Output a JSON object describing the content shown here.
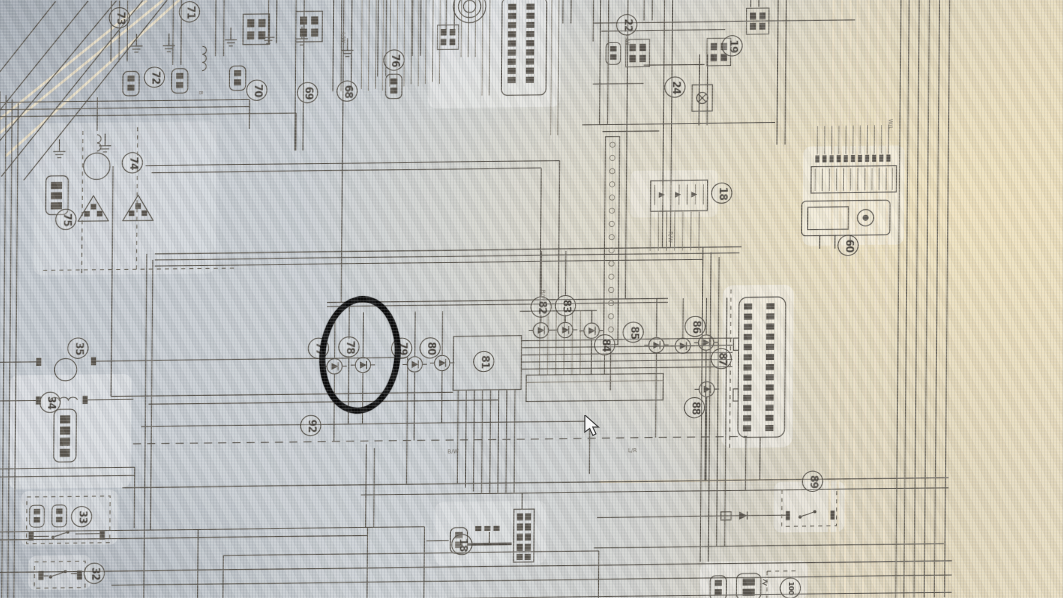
{
  "meta": {
    "description": "Photograph of a computer screen displaying a black-and-white automotive wiring diagram. Numbered circled connector references are scattered across the schematic. Component reference 78 is circled with a thick hand-drawn black marker oval. A mouse cursor arrow is visible right of center.",
    "content_type": "wiring-diagram-photo"
  },
  "colors": {
    "screen_cool": "#c6cbd1",
    "screen_warm": "#e3d8bc",
    "diagram_ink": "#5b564d",
    "diagram_ink_light": "#837d70",
    "highlight_wire": "#ecdfc3",
    "annotation_marker": "#0c0c0c",
    "cursor_fill": "#f8f8f8"
  },
  "diagram": {
    "refs": [
      {
        "label": "73",
        "x": 123,
        "y": 17
      },
      {
        "label": "71",
        "x": 192,
        "y": 12
      },
      {
        "label": "72",
        "x": 158,
        "y": 76
      },
      {
        "label": "70",
        "x": 259,
        "y": 90
      },
      {
        "label": "69",
        "x": 309,
        "y": 93
      },
      {
        "label": "68",
        "x": 348,
        "y": 92
      },
      {
        "label": "76",
        "x": 394,
        "y": 62
      },
      {
        "label": "22",
        "x": 623,
        "y": 30
      },
      {
        "label": "19",
        "x": 727,
        "y": 52
      },
      {
        "label": "24",
        "x": 671,
        "y": 92
      },
      {
        "label": "18",
        "x": 718,
        "y": 197
      },
      {
        "label": "60",
        "x": 843,
        "y": 250
      },
      {
        "label": "74",
        "x": 137,
        "y": 160
      },
      {
        "label": "75",
        "x": 72,
        "y": 215
      },
      {
        "label": "35",
        "x": 85,
        "y": 342
      },
      {
        "label": "34",
        "x": 58,
        "y": 395
      },
      {
        "label": "33",
        "x": 90,
        "y": 508
      },
      {
        "label": "32",
        "x": 103,
        "y": 564
      },
      {
        "label": "77",
        "x": 322,
        "y": 345
      },
      {
        "label": "78",
        "x": 352,
        "y": 344
      },
      {
        "label": "79",
        "x": 404,
        "y": 346
      },
      {
        "label": "80",
        "x": 432,
        "y": 346
      },
      {
        "label": "81",
        "x": 485,
        "y": 360
      },
      {
        "label": "82",
        "x": 541,
        "y": 307
      },
      {
        "label": "83",
        "x": 565,
        "y": 306
      },
      {
        "label": "84",
        "x": 604,
        "y": 345
      },
      {
        "label": "85",
        "x": 632,
        "y": 333
      },
      {
        "label": "86",
        "x": 693,
        "y": 328
      },
      {
        "label": "87",
        "x": 719,
        "y": 360
      },
      {
        "label": "88",
        "x": 693,
        "y": 408
      },
      {
        "label": "92",
        "x": 315,
        "y": 421
      },
      {
        "label": "89",
        "x": 810,
        "y": 482
      },
      {
        "label": "18",
        "x": 465,
        "y": 540
      },
      {
        "label": "100",
        "x": 789,
        "y": 587
      }
    ],
    "diodes": [
      {
        "x": 338,
        "y": 363
      },
      {
        "x": 366,
        "y": 362
      },
      {
        "x": 417,
        "y": 362
      },
      {
        "x": 444,
        "y": 361
      },
      {
        "x": 541,
        "y": 330
      },
      {
        "x": 565,
        "y": 330
      },
      {
        "x": 591,
        "y": 331
      },
      {
        "x": 655,
        "y": 346
      },
      {
        "x": 681,
        "y": 347
      },
      {
        "x": 704,
        "y": 344
      },
      {
        "x": 705,
        "y": 390
      }
    ],
    "wire_labels": [
      {
        "t": "L/W",
        "x": 346,
        "y": 34,
        "r": 90
      },
      {
        "t": "L/W",
        "x": 626,
        "y": 40,
        "r": 90
      },
      {
        "t": "B/W",
        "x": 545,
        "y": 290,
        "r": 90
      },
      {
        "t": "R/W",
        "x": 670,
        "y": 234,
        "r": 90
      },
      {
        "t": "B",
        "x": 206,
        "y": 90,
        "r": 90
      },
      {
        "t": "B/W",
        "x": 450,
        "y": 446,
        "r": 0
      },
      {
        "t": "L/R",
        "x": 628,
        "y": 447,
        "r": 0
      },
      {
        "t": "W/L",
        "x": 886,
        "y": 126,
        "r": 90
      }
    ]
  },
  "annotation": {
    "type": "hand-drawn-marker-oval",
    "target_ref": "78",
    "x": 323,
    "y": 294,
    "width": 68,
    "height": 104,
    "rotation_deg": 4,
    "stroke_px": 6.5,
    "color": "#0c0c0c"
  },
  "cursor": {
    "x": 583,
    "y": 415
  }
}
